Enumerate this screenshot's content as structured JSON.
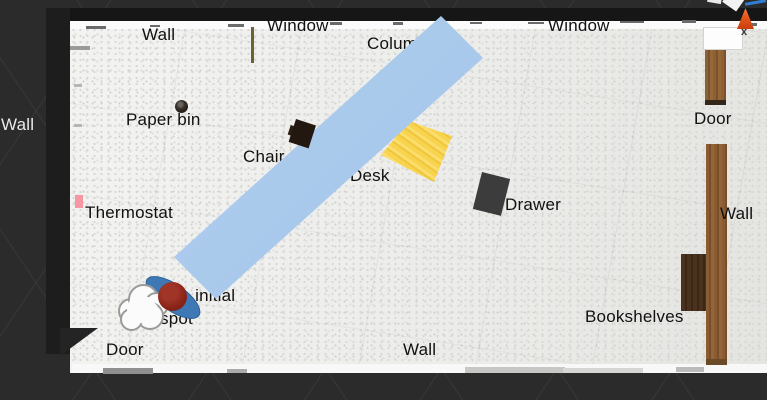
{
  "labels": {
    "wall_top": "Wall",
    "window_left": "Window",
    "column": "Column",
    "window_right": "Window",
    "wall_left": "Wall",
    "paper_bin": "Paper bin",
    "door_right": "Door",
    "chair": "Chair",
    "desk": "Desk",
    "drawer": "Drawer",
    "thermostat": "Thermostat",
    "wall_right": "Wall",
    "bookshelves": "Bookshelves",
    "avatar_spot_full": "Avatar's initial spot",
    "avatar_spot_line1": "Avatar's initial",
    "avatar_spot_line2": "spot",
    "door_bottom": "Door",
    "wall_bottom": "Wall",
    "close_glyph": "x"
  },
  "colors": {
    "background": "#2b2b2b",
    "floor": "#efefed",
    "ramp_blue": "#a9c9ec",
    "desk_yellow": "#f7d14e",
    "drawer_gray": "#3c3c3c",
    "chair_black": "#221810",
    "door_wood": "#8a5c33",
    "bookshelf_wood": "#49311c",
    "avatar_red": "#8b2419",
    "avatar_ellipse_blue": "#3e78b5",
    "thermostat_pink": "#f598a4",
    "cone_orange": "#e4561c",
    "gizmo_axis_blue": "#2f7fd6"
  }
}
